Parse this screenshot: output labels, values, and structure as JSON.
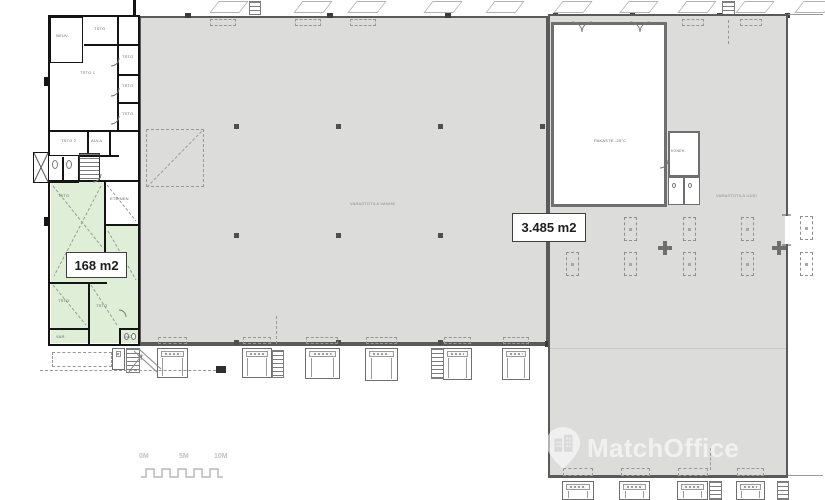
{
  "area_labels": {
    "left_unit": "168 m2",
    "right_unit": "3.485 m2"
  },
  "hall_labels": {
    "main_hall": "VARASTOTILA VANHA",
    "right_hall": "VARASTOTILA UUSI",
    "cold_room": "PAKASTE -25°C",
    "machine_room": "KONEH."
  },
  "left_wing": {
    "neuv": "NEUV.",
    "tsto_top": "TSTO",
    "tsto_r1": "TSTO",
    "tsto_r2": "TSTO",
    "tsto_r3": "TSTO",
    "tsto1": "TSTO 1",
    "tsto2": "TSTO 2",
    "aula": "AULA",
    "eteinen": "ETEINEN",
    "g_tsto1": "TSTO",
    "g_tsto2": "TSTO",
    "g_tsto3": "TSTO",
    "g_var": "VAR.",
    "g_wc": "WC"
  },
  "scale_bar": {
    "m0": "0M",
    "m5": "5M",
    "m10": "10M"
  },
  "watermark": {
    "brand": "MatchOffice",
    "icon": "map-pin-building-icon"
  },
  "colors": {
    "hall_fill": "#dcdddb",
    "highlight_green": "#dfeed7",
    "wall_gray": "#5a5a5a",
    "wall_black": "#141414",
    "watermark_text": "rgba(255,255,255,0.58)"
  }
}
